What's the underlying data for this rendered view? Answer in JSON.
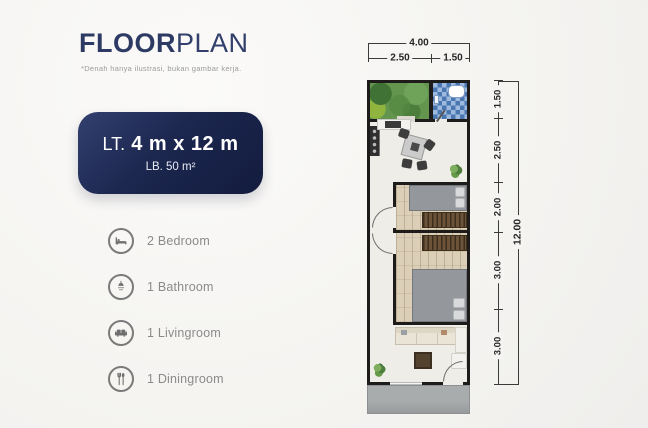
{
  "header": {
    "title_bold": "FLOOR",
    "title_light": "PLAN",
    "subtitle": "*Denah hanya ilustrasi, bukan gambar kerja."
  },
  "badge": {
    "label_prefix": "LT.",
    "label_value": "4 m x 12 m",
    "sub_label": "LB. 50 m²"
  },
  "legend": {
    "items": [
      {
        "icon": "bed-icon",
        "label": "2 Bedroom"
      },
      {
        "icon": "shower-icon",
        "label": "1 Bathroom"
      },
      {
        "icon": "sofa-icon",
        "label": "1 Livingroom"
      },
      {
        "icon": "cutlery-icon",
        "label": "1 Diningroom"
      }
    ]
  },
  "floorplan": {
    "dim_top": {
      "total": "4.00",
      "segments": [
        "2.50",
        "1.50"
      ]
    },
    "dim_right": {
      "total": "12.00",
      "segments": [
        "1.50",
        "2.50",
        "2.00",
        "3.00",
        "3.00"
      ]
    }
  },
  "colors": {
    "accent_navy": "#1c274f",
    "wall": "#1d1c1a",
    "wood_floor": "#dbcfb8",
    "garden_green": "#63954e",
    "bathroom_tile": "#4a77b2",
    "terrace_gray": "#a9acad"
  }
}
